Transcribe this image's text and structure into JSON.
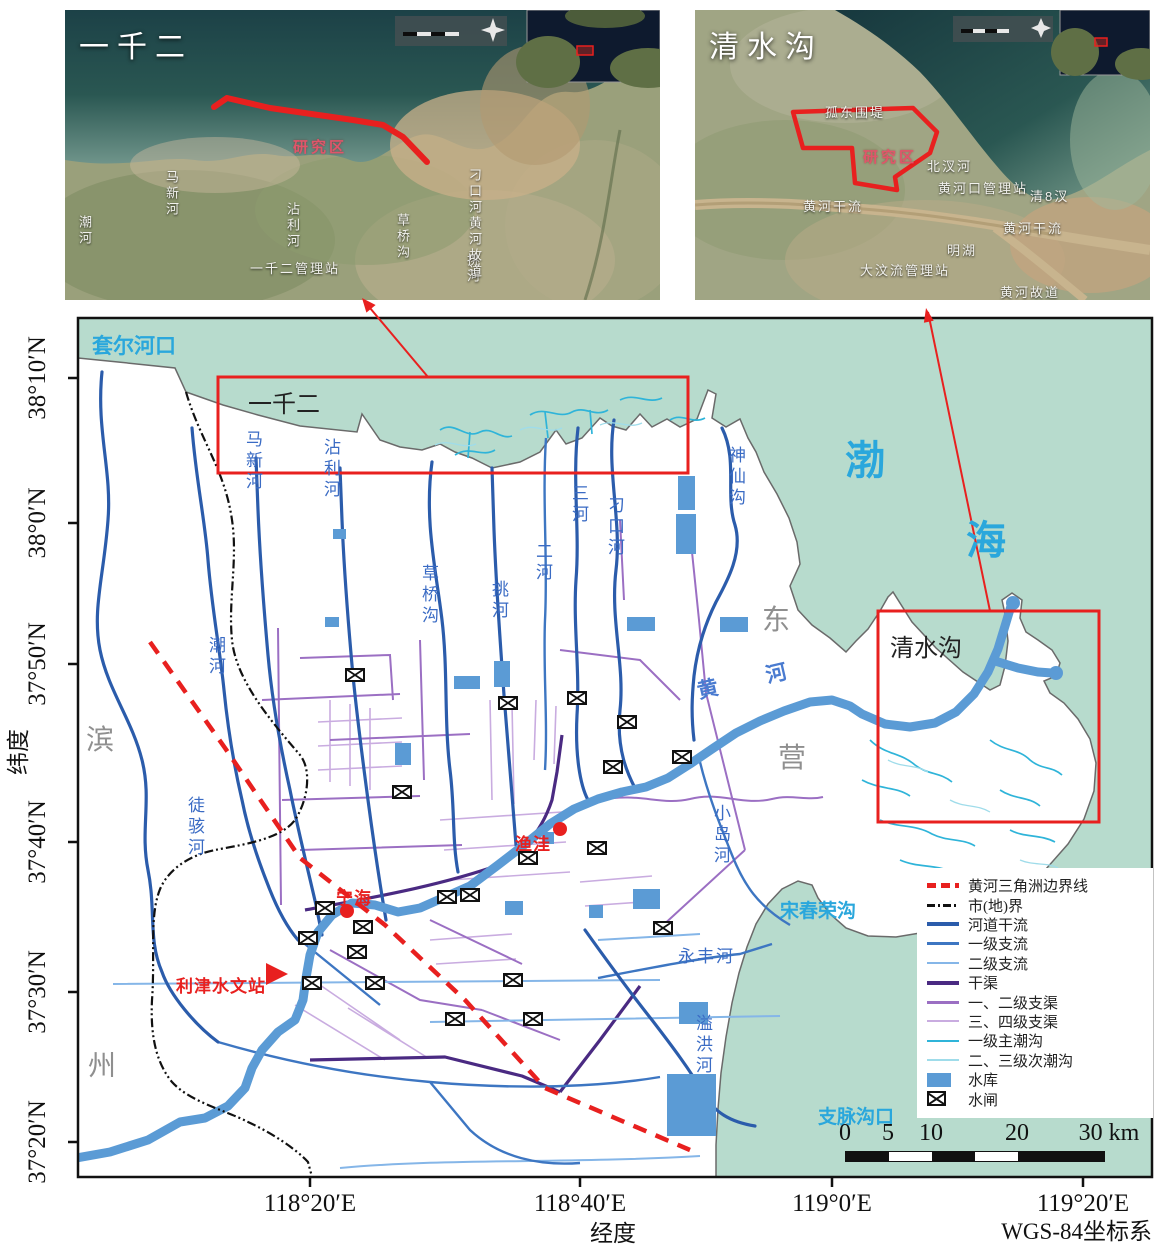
{
  "colors": {
    "sea": "#b7dbcd",
    "red": "#e8201f",
    "river_main": "#2b5cab",
    "tributary1": "#3d76c2",
    "tributary2": "#85b6e8",
    "canal_main": "#4a2a82",
    "canal_12": "#9b6fc3",
    "canal_34": "#c9ace0",
    "tidal_1": "#2fb4d9",
    "tidal_2": "#9fdcea",
    "reservoir": "#5b9bd5",
    "yellow_river": "#5b9bd5",
    "sea_label": "#2aa7dc",
    "city_label": "#8f8f8f",
    "river_label": "#3a6bc4"
  },
  "insets": {
    "left": {
      "labels": [
        {
          "name": "inset1-title",
          "text": "一千二",
          "x": 14,
          "y": 12,
          "cls": "ins-title"
        },
        {
          "name": "inset1-study-area",
          "text": "研究区",
          "x": 228,
          "y": 126,
          "cls": "ins-pink"
        },
        {
          "name": "inset1-label-maxinhe",
          "text": "马新河",
          "x": 97,
          "y": 160,
          "cls": "ins-white-v"
        },
        {
          "name": "inset1-label-chaohe",
          "text": "潮河",
          "x": 10,
          "y": 205,
          "cls": "ins-white-v"
        },
        {
          "name": "inset1-label-zhanlihe",
          "text": "沾利河",
          "x": 218,
          "y": 192,
          "cls": "ins-white-v"
        },
        {
          "name": "inset1-label-caoqiaogou",
          "text": "草桥沟",
          "x": 328,
          "y": 203,
          "cls": "ins-white-v"
        },
        {
          "name": "inset1-label-tiaohe",
          "text": "挑河",
          "x": 398,
          "y": 243,
          "cls": "ins-white-v"
        },
        {
          "name": "inset1-label-guanlizhan",
          "text": "一千二管理站",
          "x": 185,
          "y": 248,
          "cls": "ins-white"
        },
        {
          "name": "inset1-label-diaokou-gudao",
          "text": "刁口河黄河故道",
          "x": 400,
          "y": 158,
          "cls": "ins-white-v"
        }
      ]
    },
    "right": {
      "labels": [
        {
          "name": "inset2-title",
          "text": "清水沟",
          "x": 14,
          "y": 12,
          "cls": "ins-title"
        },
        {
          "name": "inset2-study-area",
          "text": "研究区",
          "x": 168,
          "y": 136,
          "cls": "ins-pink"
        },
        {
          "name": "inset2-label-gudong",
          "text": "孤东围堤",
          "x": 130,
          "y": 92,
          "cls": "ins-white"
        },
        {
          "name": "inset2-label-beichahe",
          "text": "北汊河",
          "x": 232,
          "y": 146,
          "cls": "ins-white"
        },
        {
          "name": "inset2-label-huanghekou-glz",
          "text": "黄河口管理站",
          "x": 243,
          "y": 168,
          "cls": "ins-white"
        },
        {
          "name": "inset2-label-qing8cha",
          "text": "清8汊",
          "x": 335,
          "y": 176,
          "cls": "ins-white"
        },
        {
          "name": "inset2-label-huanghe-ganliu-1",
          "text": "黄河干流",
          "x": 108,
          "y": 186,
          "cls": "ins-white"
        },
        {
          "name": "inset2-label-huanghe-ganliu-2",
          "text": "黄河干流",
          "x": 308,
          "y": 208,
          "cls": "ins-white"
        },
        {
          "name": "inset2-label-minghu",
          "text": "明湖",
          "x": 252,
          "y": 230,
          "cls": "ins-white"
        },
        {
          "name": "inset2-label-dawenliu",
          "text": "大汶流管理站",
          "x": 165,
          "y": 250,
          "cls": "ins-white"
        },
        {
          "name": "inset2-label-gudao",
          "text": "黄河故道",
          "x": 305,
          "y": 272,
          "cls": "ins-white"
        }
      ]
    }
  },
  "map_labels": [
    {
      "name": "sea-label-taoerhekou",
      "text": "套尔河口",
      "x": 92,
      "y": 330,
      "cls": "sea-cyan"
    },
    {
      "name": "sea-label-bohai-bo",
      "text": "渤",
      "x": 845,
      "y": 428,
      "cls": "sea-cyan-lg"
    },
    {
      "name": "sea-label-bohai-hai",
      "text": "海",
      "x": 966,
      "y": 508,
      "cls": "sea-cyan-lg"
    },
    {
      "name": "sea-label-songchunronggou",
      "text": "宋春荣沟",
      "x": 780,
      "y": 896,
      "cls": "sea-cyan-sm"
    },
    {
      "name": "sea-label-zhimaigoukou",
      "text": "支脉沟口",
      "x": 818,
      "y": 1102,
      "cls": "sea-cyan-sm"
    },
    {
      "name": "city-label-bin",
      "text": "滨",
      "x": 86,
      "y": 718,
      "cls": "city-gray"
    },
    {
      "name": "city-label-zhou",
      "text": "州",
      "x": 88,
      "y": 1044,
      "cls": "city-gray"
    },
    {
      "name": "city-label-dong",
      "text": "东",
      "x": 762,
      "y": 598,
      "cls": "city-gray"
    },
    {
      "name": "city-label-ying",
      "text": "营",
      "x": 778,
      "y": 736,
      "cls": "city-gray"
    },
    {
      "name": "area-label-yiqianer",
      "text": "一千二",
      "x": 248,
      "y": 384,
      "cls": "box-black"
    },
    {
      "name": "area-label-qingshuigou",
      "text": "清水沟",
      "x": 890,
      "y": 628,
      "cls": "box-black"
    },
    {
      "name": "river-label-tuhaihe",
      "text": "徒骇河",
      "x": 182,
      "y": 796,
      "cls": "riv-v"
    },
    {
      "name": "river-label-chaohe",
      "text": "潮河",
      "x": 203,
      "y": 636,
      "cls": "riv-v"
    },
    {
      "name": "river-label-maxinhe",
      "text": "马新河",
      "x": 240,
      "y": 430,
      "cls": "riv-v"
    },
    {
      "name": "river-label-zhanlihe",
      "text": "沾利河",
      "x": 318,
      "y": 438,
      "cls": "riv-v"
    },
    {
      "name": "river-label-caoqiaogou",
      "text": "草桥沟",
      "x": 416,
      "y": 564,
      "cls": "riv-v"
    },
    {
      "name": "river-label-tiaohe",
      "text": "挑河",
      "x": 486,
      "y": 580,
      "cls": "riv-v"
    },
    {
      "name": "river-label-erhe",
      "text": "二河",
      "x": 530,
      "y": 542,
      "cls": "riv-v"
    },
    {
      "name": "river-label-sanhe",
      "text": "三河",
      "x": 566,
      "y": 484,
      "cls": "riv-v"
    },
    {
      "name": "river-label-diaokouhe",
      "text": "刁口河",
      "x": 602,
      "y": 496,
      "cls": "riv-v"
    },
    {
      "name": "river-label-shenxiangou",
      "text": "神仙沟",
      "x": 723,
      "y": 446,
      "cls": "riv-v"
    },
    {
      "name": "river-label-xiaodaohe",
      "text": "小岛河",
      "x": 708,
      "y": 804,
      "cls": "riv-v"
    },
    {
      "name": "river-label-yongfenghe",
      "text": "永丰河",
      "x": 678,
      "y": 942,
      "cls": "riv-h"
    },
    {
      "name": "river-label-yihonghe",
      "text": "溢洪河",
      "x": 690,
      "y": 1014,
      "cls": "riv-v"
    },
    {
      "name": "river-label-huanghe",
      "text": "黄 河",
      "x": 694,
      "y": 676,
      "cls": "riv-huanghe",
      "rot": -13
    },
    {
      "name": "station-label-lijin",
      "text": "利津水文站",
      "x": 176,
      "y": 972,
      "cls": "red-label"
    },
    {
      "name": "station-label-ninghai",
      "text": "宁海",
      "x": 336,
      "y": 884,
      "cls": "red-label"
    },
    {
      "name": "station-label-yuwa",
      "text": "渔洼",
      "x": 515,
      "y": 830,
      "cls": "red-label"
    },
    {
      "name": "y-tick-38-10",
      "text": "38°10′N",
      "x": 38,
      "y": 378,
      "cls": "ytick"
    },
    {
      "name": "y-tick-38-0",
      "text": "38°0′N",
      "x": 38,
      "y": 523,
      "cls": "ytick"
    },
    {
      "name": "y-tick-37-50",
      "text": "37°50′N",
      "x": 38,
      "y": 664,
      "cls": "ytick"
    },
    {
      "name": "y-tick-37-40",
      "text": "37°40′N",
      "x": 38,
      "y": 842,
      "cls": "ytick"
    },
    {
      "name": "y-tick-37-30",
      "text": "37°30′N",
      "x": 38,
      "y": 992,
      "cls": "ytick"
    },
    {
      "name": "y-tick-37-20",
      "text": "37°20′N",
      "x": 38,
      "y": 1142,
      "cls": "ytick"
    },
    {
      "name": "x-tick-118-20",
      "text": "118°20′E",
      "x": 310,
      "y": 1190,
      "cls": "xtick"
    },
    {
      "name": "x-tick-118-40",
      "text": "118°40′E",
      "x": 580,
      "y": 1190,
      "cls": "xtick"
    },
    {
      "name": "x-tick-119-0",
      "text": "119°0′E",
      "x": 832,
      "y": 1190,
      "cls": "xtick"
    },
    {
      "name": "x-tick-119-20",
      "text": "119°20′E",
      "x": 1083,
      "y": 1190,
      "cls": "xtick"
    },
    {
      "name": "axis-title-lat",
      "text": "纬度",
      "x": 16,
      "y": 752,
      "cls": "ytitle"
    },
    {
      "name": "axis-title-lon",
      "text": "经度",
      "x": 613,
      "y": 1214,
      "cls": "xtitle"
    },
    {
      "name": "crs-label",
      "text": "WGS-84坐标系",
      "x": 1152,
      "y": 1212,
      "cls": "crs"
    }
  ],
  "legend": {
    "items": [
      {
        "label": "黄河三角洲边界线",
        "swatch": "sw-dash-red"
      },
      {
        "label": "市(地)界",
        "swatch": "sw-dashdot-black"
      },
      {
        "label": "河道干流",
        "swatch": "sw-line-main"
      },
      {
        "label": "一级支流",
        "swatch": "sw-line-b1"
      },
      {
        "label": "二级支流",
        "swatch": "sw-line-b2"
      },
      {
        "label": "干渠",
        "swatch": "sw-line-c0"
      },
      {
        "label": "一、二级支渠",
        "swatch": "sw-line-c1"
      },
      {
        "label": "三、四级支渠",
        "swatch": "sw-line-c2"
      },
      {
        "label": "一级主潮沟",
        "swatch": "sw-line-t1"
      },
      {
        "label": "二、三级次潮沟",
        "swatch": "sw-line-t2"
      },
      {
        "label": "水库",
        "swatch": "sw-rect"
      },
      {
        "label": "水闸",
        "swatch": "sw-gate"
      }
    ]
  },
  "scalebar": {
    "ticks": [
      {
        "t": "0",
        "x": 0
      },
      {
        "t": "5",
        "x": 43
      },
      {
        "t": "10",
        "x": 86
      },
      {
        "t": "20",
        "x": 172
      },
      {
        "t": "30 km",
        "x": 264
      }
    ],
    "segments": [
      {
        "w": 43,
        "c": "#111111"
      },
      {
        "w": 43,
        "c": "#ffffff"
      },
      {
        "w": 43,
        "c": "#111111"
      },
      {
        "w": 43,
        "c": "#ffffff"
      },
      {
        "w": 86,
        "c": "#111111"
      }
    ]
  },
  "map_markers": {
    "gates": [
      [
        355,
        675
      ],
      [
        508,
        703
      ],
      [
        577,
        698
      ],
      [
        627,
        722
      ],
      [
        682,
        757
      ],
      [
        613,
        767
      ],
      [
        402,
        792
      ],
      [
        597,
        848
      ],
      [
        528,
        858
      ],
      [
        470,
        895
      ],
      [
        447,
        897
      ],
      [
        363,
        927
      ],
      [
        325,
        908
      ],
      [
        308,
        938
      ],
      [
        357,
        952
      ],
      [
        312,
        983
      ],
      [
        375,
        983
      ],
      [
        513,
        980
      ],
      [
        455,
        1019
      ],
      [
        533,
        1019
      ],
      [
        663,
        928
      ]
    ],
    "reservoirs": [
      [
        678,
        476,
        17,
        34
      ],
      [
        676,
        514,
        20,
        40
      ],
      [
        627,
        617,
        28,
        14
      ],
      [
        720,
        617,
        28,
        15
      ],
      [
        494,
        661,
        16,
        26
      ],
      [
        454,
        676,
        26,
        13
      ],
      [
        633,
        889,
        27,
        20
      ],
      [
        589,
        905,
        14,
        13
      ],
      [
        542,
        832,
        12,
        12
      ],
      [
        505,
        901,
        18,
        14
      ],
      [
        679,
        1002,
        29,
        22
      ],
      [
        667,
        1074,
        49,
        62
      ],
      [
        325,
        617,
        14,
        10
      ],
      [
        333,
        529,
        13,
        10
      ],
      [
        395,
        743,
        16,
        22
      ]
    ],
    "red_dots": [
      [
        560,
        829
      ],
      [
        347,
        911
      ]
    ],
    "mouth_dots": [
      [
        1013,
        603
      ],
      [
        1056,
        673
      ]
    ],
    "station_triangle": "266,963 288,974 266,985"
  }
}
